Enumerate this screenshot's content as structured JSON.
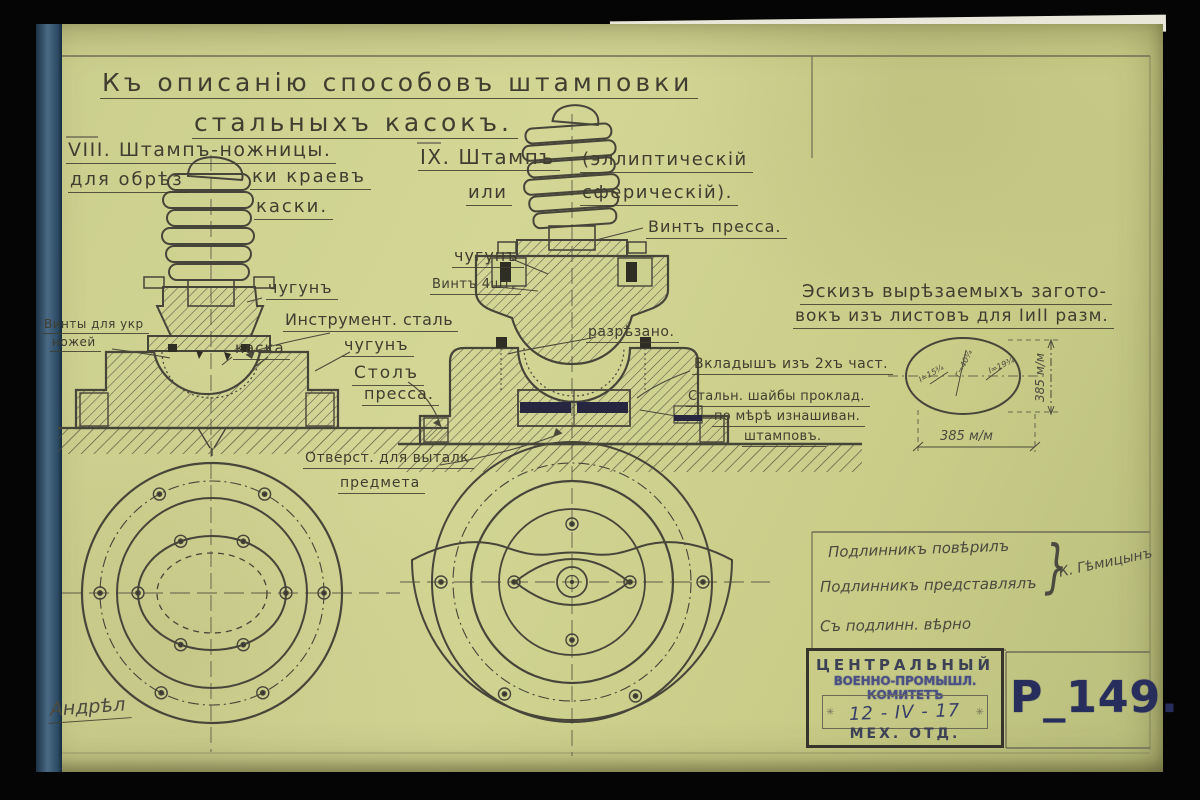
{
  "titles": {
    "l1": "Къ описанію способовъ штамповки",
    "l2": "стальныхъ касокъ."
  },
  "fig8": {
    "h": "VIII. Штампъ-ножницы.",
    "s1": "для обрѣз",
    "s2": "ки краевъ",
    "s3": "каски.",
    "chugun": "чугунъ",
    "instr": "Инструмент. сталь",
    "chugun2": "чугунъ",
    "kaska": "каска",
    "stol1": "Столъ",
    "stol2": "пресса.",
    "vinty1": "Винты для укр",
    "vinty2": "ножей",
    "otv1": "Отверст. для выталк",
    "otv2": "предмета"
  },
  "fig9": {
    "h": "IX. Штампъ",
    "p1": "(эллиптическій",
    "or": "или",
    "p2": "сферическій).",
    "vint": "Винтъ пресса.",
    "chugun": "чугунъ",
    "vint4": "Винтъ 4шт.",
    "razr": "разрѣзано.",
    "vklad": "Вкладышъ изъ 2хъ част.",
    "sh1": "Стальн. шайбы проклад.",
    "sh2": "по мѣрѣ изнашиван.",
    "sh3": "штамповъ."
  },
  "sketch": {
    "c1": "Эскизъ вырѣзаемыхъ загото-",
    "c2": "вокъ изъ листовъ для IиII разм.",
    "dw": "385 м/м",
    "dh": "385 м/м",
    "n1": "I=15¾",
    "n2": "Г=40¾",
    "n3": "I=19¾"
  },
  "sig": {
    "l1": "Подлинникъ повѣрилъ",
    "l2": "Подлинникъ представлялъ",
    "l3": "Съ подлинн. вѣрно",
    "brace": "}",
    "name": "К. Гѣмицынъ",
    "bl": "Андрѣл"
  },
  "stamp": {
    "o1": "ЦЕНТРАЛЬНЫЙ",
    "o2": "ВОЕННО-ПРОМЫШЛ. КОМИТЕТЪ",
    "date": "12 - IV - 17",
    "dept": "МЕХ. ОТД.",
    "orn": "✳",
    "num": "Р_149."
  }
}
